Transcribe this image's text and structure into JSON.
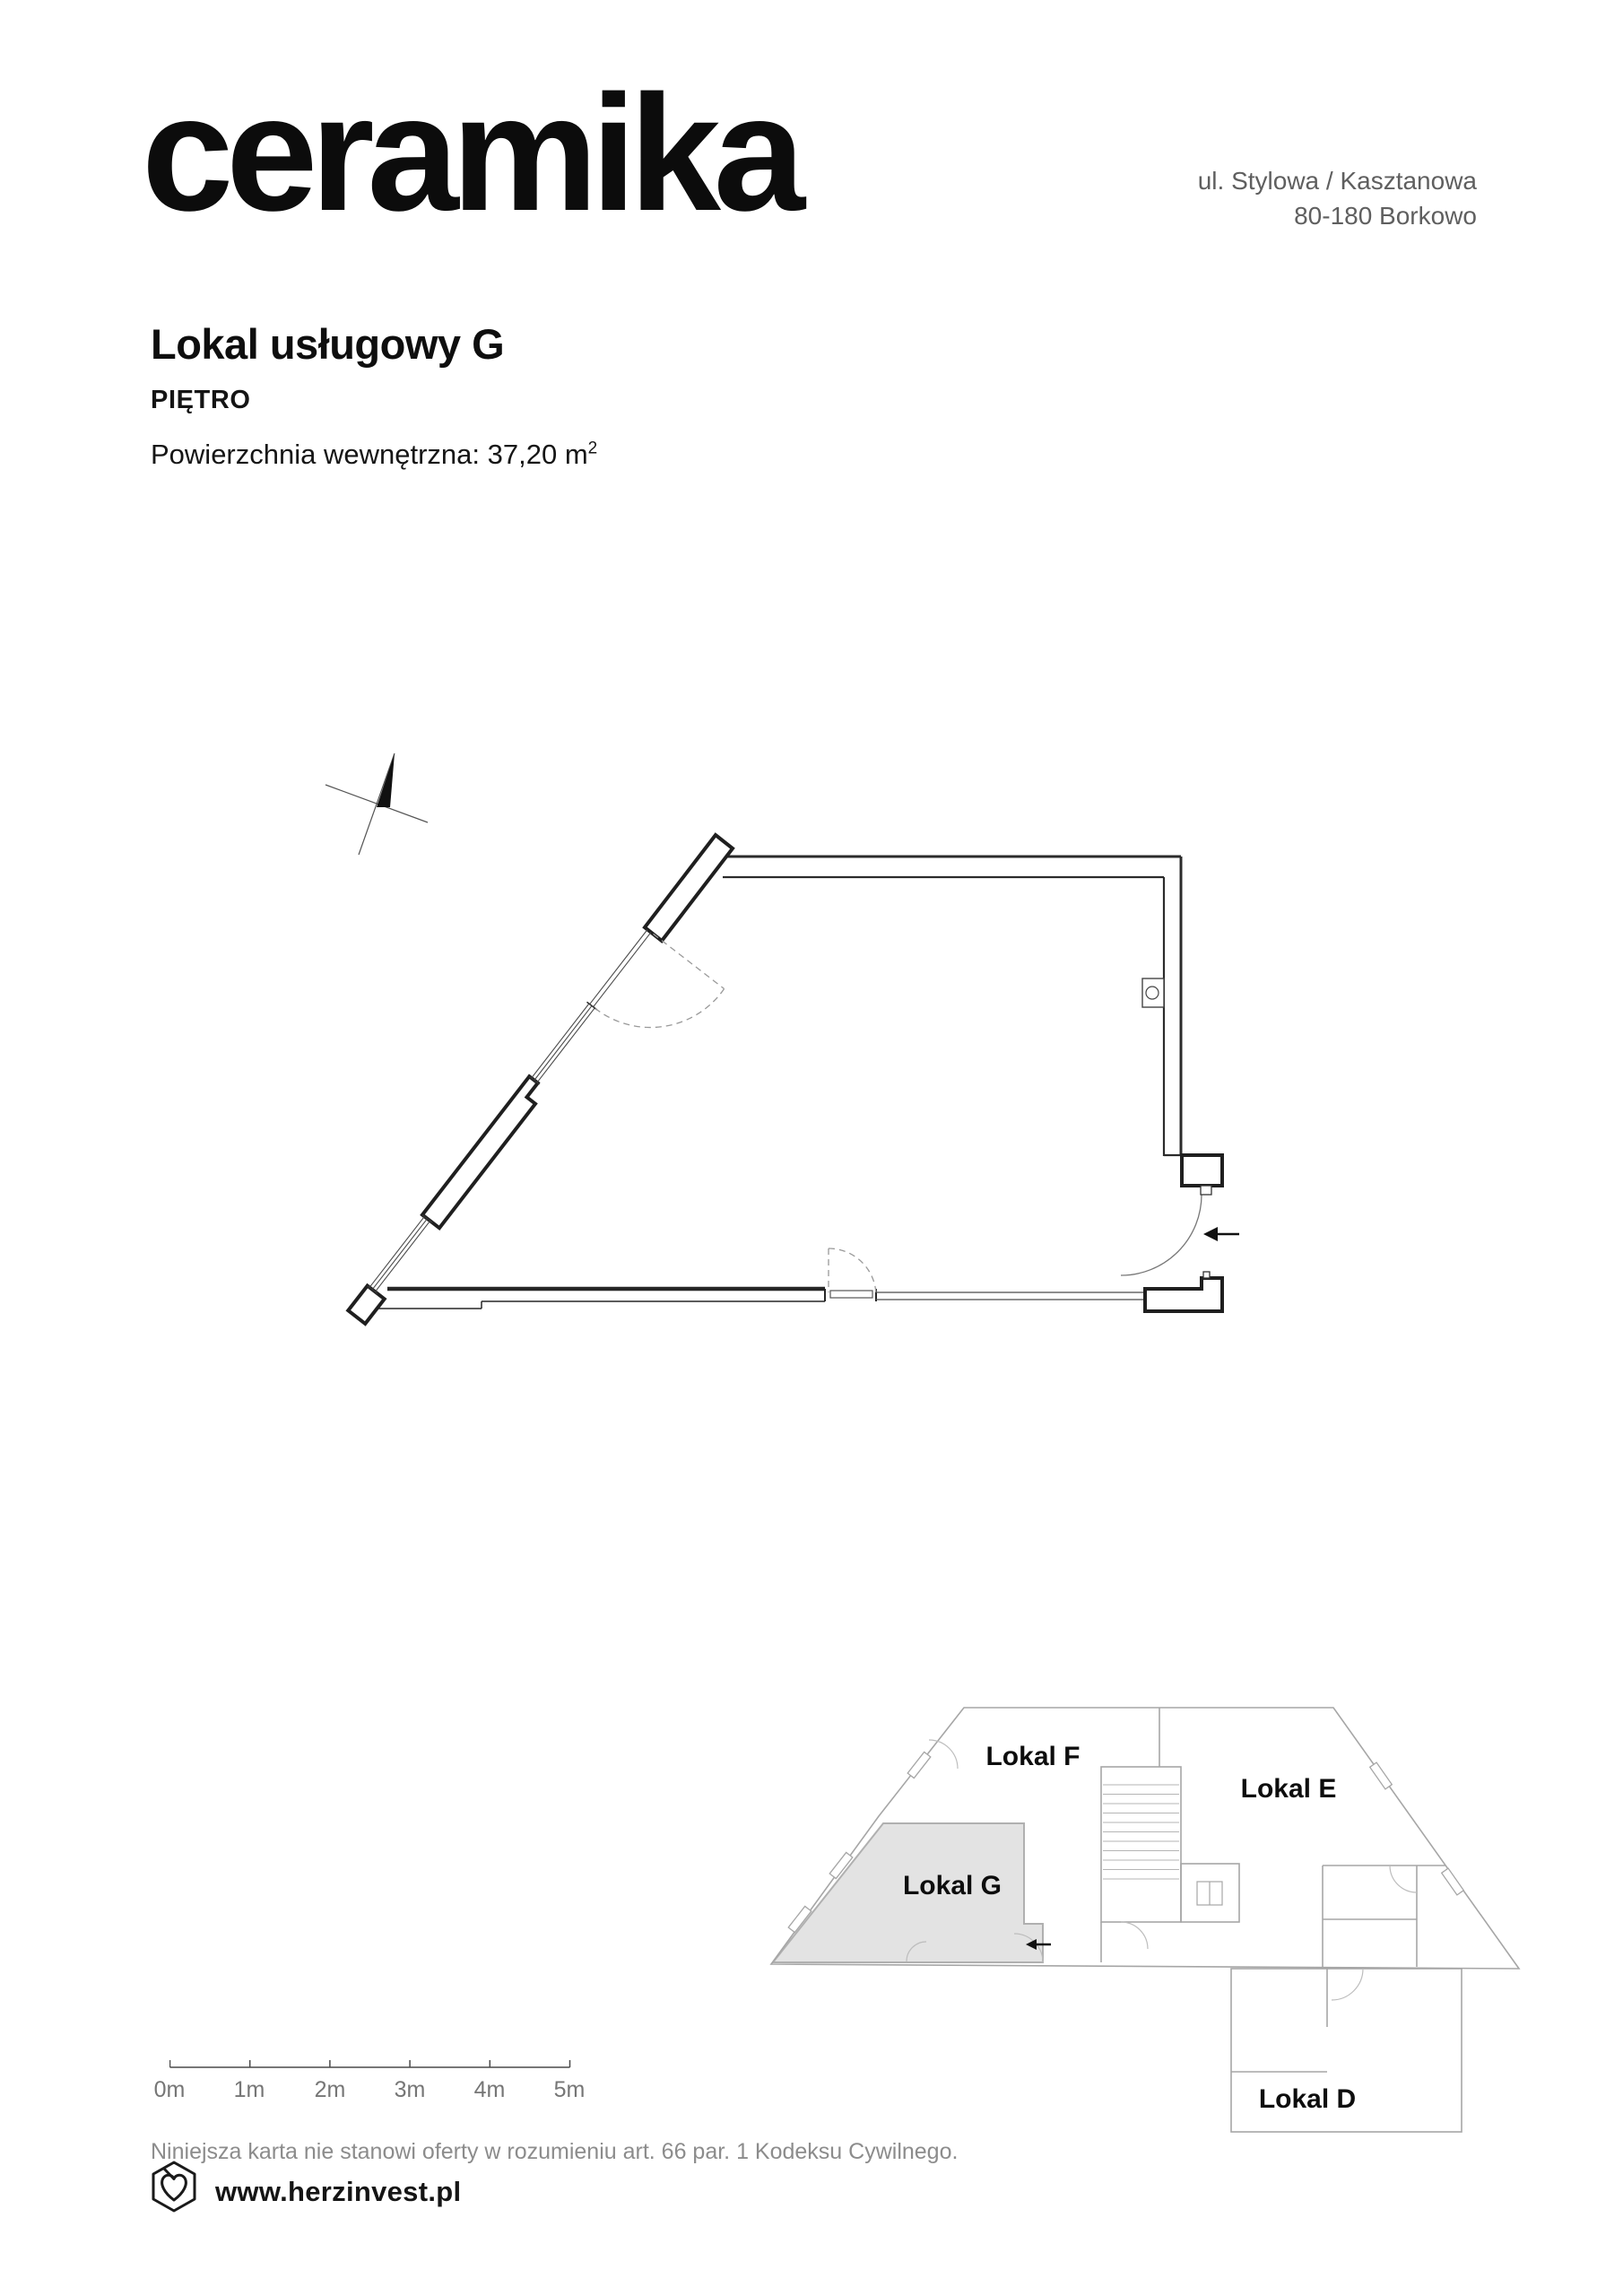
{
  "header": {
    "brand": "ceramika",
    "address_line1": "ul. Stylowa / Kasztanowa",
    "address_line2": "80-180 Borkowo"
  },
  "unit": {
    "title": "Lokal usługowy G",
    "floor_label": "PIĘTRO",
    "area_label": "Powierzchnia wewnętrzna:",
    "area_value": " 37,20 m",
    "area_exponent": "2"
  },
  "floorplan": {
    "type": "architectural-plan",
    "features": [
      "north-arrow",
      "diagonal-window-wall",
      "dashed-door-swings",
      "entrance-door",
      "electrical-box",
      "entrance-arrow"
    ]
  },
  "keyplan": {
    "highlighted_unit": "Lokal G",
    "units": [
      {
        "label": "Lokal F",
        "highlighted": false
      },
      {
        "label": "Lokal E",
        "highlighted": false
      },
      {
        "label": "Lokal G",
        "highlighted": true
      },
      {
        "label": "Lokal D",
        "highlighted": false
      }
    ]
  },
  "scalebar": {
    "labels": [
      "0m",
      "1m",
      "2m",
      "3m",
      "4m",
      "5m"
    ]
  },
  "legal": {
    "disclaimer": "Niniejsza karta nie stanowi oferty w rozumieniu art. 66 par. 1 Kodeksu Cywilnego."
  },
  "footer": {
    "website": "www.herzinvest.pl",
    "logo": "hexagon-heart-logo"
  },
  "colors": {
    "ink": "#111111",
    "muted_text": "#5f5f5f",
    "light_text": "#8c8c8c",
    "plan_line": "#2b2b2b",
    "keyplan_line": "#a6a6a6",
    "highlight_fill": "#e3e3e3",
    "highlight_stroke": "#b0b0b0"
  }
}
